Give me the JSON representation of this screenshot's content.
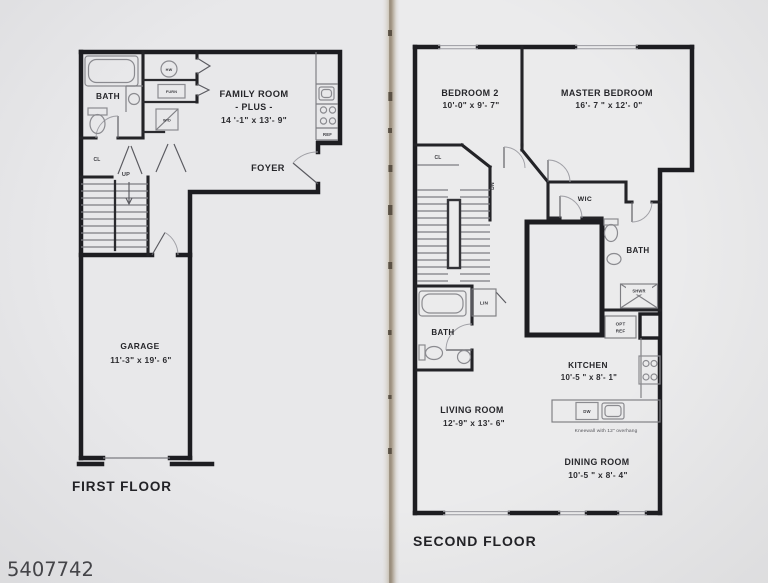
{
  "photo_id": "5407742",
  "colors": {
    "ink": "#1d1d21",
    "paper": "#e9e9eb",
    "spine": "#a99d8c"
  },
  "first_floor": {
    "title": "FIRST FLOOR",
    "bath": "BATH",
    "hw": "HW",
    "furn": "FURN",
    "wd": "W/D",
    "cl": "CL",
    "up": "UP",
    "ref": "REF",
    "family_room_line1": "FAMILY ROOM",
    "family_room_line2": "- PLUS -",
    "family_room_dims": "14 '-1\" x 13'- 9\"",
    "foyer": "FOYER",
    "garage": "GARAGE",
    "garage_dims": "11'-3\" x 19'- 6\""
  },
  "second_floor": {
    "title": "SECOND FLOOR",
    "bedroom2": "BEDROOM 2",
    "bedroom2_dims": "10'-0\" x 9'- 7\"",
    "master_bedroom": "MASTER BEDROOM",
    "master_bedroom_dims": "16'- 7 \" x 12'- 0\"",
    "cl": "CL",
    "dn": "DN",
    "wic": "WIC",
    "bath_right": "BATH",
    "shwr": "SHWR",
    "opt": "OPT",
    "opt_ref": "REF",
    "lin": "LIN",
    "bath_left": "BATH",
    "kitchen": "KITCHEN",
    "kitchen_dims": "10'-5 \" x 8'- 1\"",
    "dw": "DW",
    "kneewall_note": "Kneewall with 12\" overhang",
    "living_room": "LIVING ROOM",
    "living_room_dims": "12'-9\" x 13'- 6\"",
    "dining_room": "DINING ROOM",
    "dining_room_dims": "10'-5 \" x 8'- 4\""
  }
}
